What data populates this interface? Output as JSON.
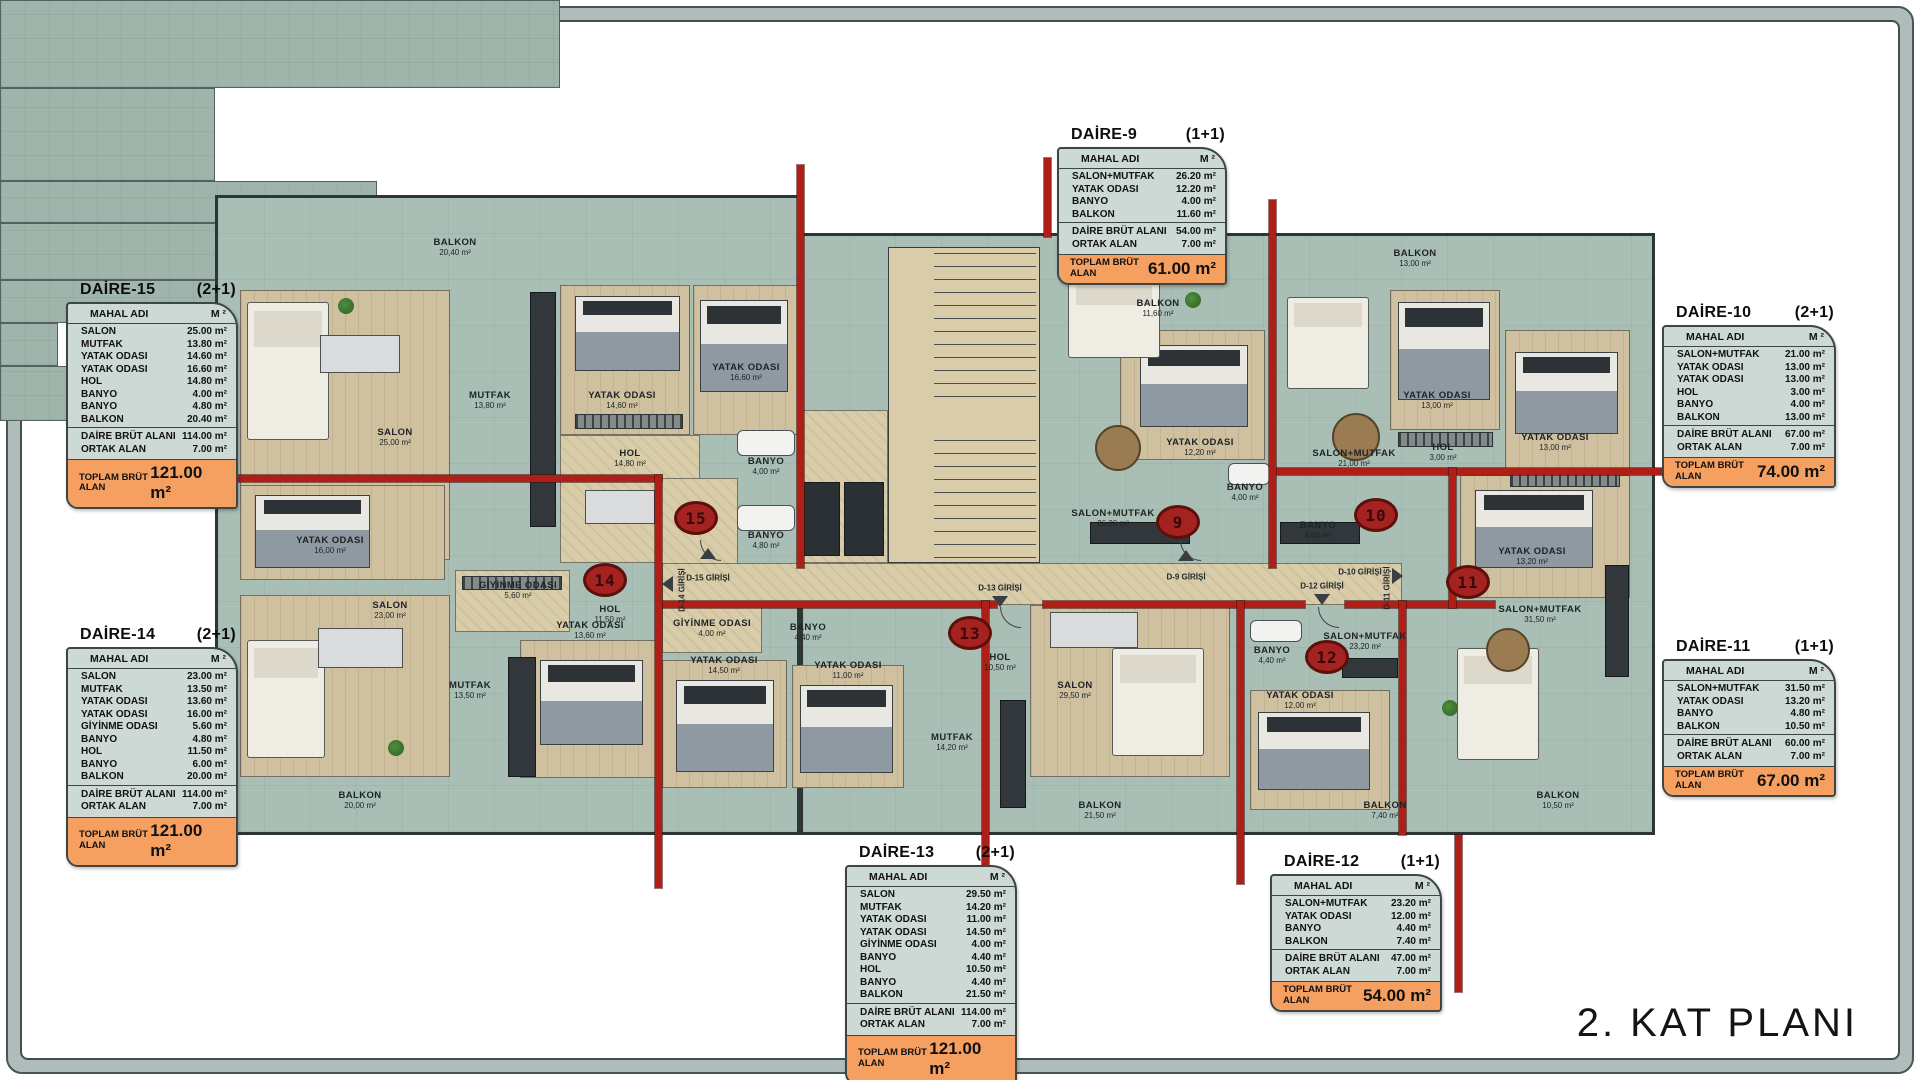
{
  "title": "2. KAT PLANI",
  "colors": {
    "section_red": "#ad1f17",
    "tile_green": "#a9beb4",
    "wood": "#cfc0a0",
    "corridor_tan": "#d8cca9",
    "total_orange": "#f59f60",
    "table_bg": "#ccd9d4"
  },
  "labels": {
    "mahal_adi": "MAHAL ADI",
    "m2": "M ²",
    "daire_brut": "DAİRE BRÜT ALANI",
    "ortak_alan": "ORTAK ALAN",
    "toplam_brut": "TOPLAM BRÜT ALAN"
  },
  "apartments": [
    {
      "name": "DAİRE-15",
      "type": "(2+1)",
      "rows": [
        {
          "label": "SALON",
          "value": "25.00 m²"
        },
        {
          "label": "MUTFAK",
          "value": "13.80 m²"
        },
        {
          "label": "YATAK ODASI",
          "value": "14.60 m²"
        },
        {
          "label": "YATAK ODASI",
          "value": "16.60 m²"
        },
        {
          "label": "HOL",
          "value": "14.80 m²"
        },
        {
          "label": "BANYO",
          "value": "4.00 m²"
        },
        {
          "label": "BANYO",
          "value": "4.80 m²"
        },
        {
          "label": "BALKON",
          "value": "20.40 m²"
        }
      ],
      "brut": "114.00 m²",
      "ortak": "7.00 m²",
      "toplam": "121.00 m²"
    },
    {
      "name": "DAİRE-14",
      "type": "(2+1)",
      "rows": [
        {
          "label": "SALON",
          "value": "23.00 m²"
        },
        {
          "label": "MUTFAK",
          "value": "13.50 m²"
        },
        {
          "label": "YATAK ODASI",
          "value": "13.60 m²"
        },
        {
          "label": "YATAK ODASI",
          "value": "16.00 m²"
        },
        {
          "label": "GİYİNME ODASI",
          "value": "5.60 m²"
        },
        {
          "label": "BANYO",
          "value": "4.80 m²"
        },
        {
          "label": "HOL",
          "value": "11.50 m²"
        },
        {
          "label": "BANYO",
          "value": "6.00 m²"
        },
        {
          "label": "BALKON",
          "value": "20.00 m²"
        }
      ],
      "brut": "114.00 m²",
      "ortak": "7.00 m²",
      "toplam": "121.00 m²"
    },
    {
      "name": "DAİRE-9",
      "type": "(1+1)",
      "rows": [
        {
          "label": "SALON+MUTFAK",
          "value": "26.20 m²"
        },
        {
          "label": "YATAK ODASI",
          "value": "12.20 m²"
        },
        {
          "label": "BANYO",
          "value": "4.00 m²"
        },
        {
          "label": "BALKON",
          "value": "11.60 m²"
        }
      ],
      "brut": "54.00 m²",
      "ortak": "7.00 m²",
      "toplam": "61.00 m²"
    },
    {
      "name": "DAİRE-10",
      "type": "(2+1)",
      "rows": [
        {
          "label": "SALON+MUTFAK",
          "value": "21.00 m²"
        },
        {
          "label": "YATAK ODASI",
          "value": "13.00 m²"
        },
        {
          "label": "YATAK ODASI",
          "value": "13.00 m²"
        },
        {
          "label": "HOL",
          "value": "3.00 m²"
        },
        {
          "label": "BANYO",
          "value": "4.00 m²"
        },
        {
          "label": "BALKON",
          "value": "13.00 m²"
        }
      ],
      "brut": "67.00 m²",
      "ortak": "7.00 m²",
      "toplam": "74.00 m²"
    },
    {
      "name": "DAİRE-11",
      "type": "(1+1)",
      "rows": [
        {
          "label": "SALON+MUTFAK",
          "value": "31.50 m²"
        },
        {
          "label": "YATAK ODASI",
          "value": "13.20 m²"
        },
        {
          "label": "BANYO",
          "value": "4.80 m²"
        },
        {
          "label": "BALKON",
          "value": "10.50 m²"
        }
      ],
      "brut": "60.00 m²",
      "ortak": "7.00 m²",
      "toplam": "67.00 m²"
    },
    {
      "name": "DAİRE-13",
      "type": "(2+1)",
      "rows": [
        {
          "label": "SALON",
          "value": "29.50 m²"
        },
        {
          "label": "MUTFAK",
          "value": "14.20 m²"
        },
        {
          "label": "YATAK ODASI",
          "value": "11.00 m²"
        },
        {
          "label": "YATAK ODASI",
          "value": "14.50 m²"
        },
        {
          "label": "GİYİNME ODASI",
          "value": "4.00 m²"
        },
        {
          "label": "BANYO",
          "value": "4.40 m²"
        },
        {
          "label": "HOL",
          "value": "10.50 m²"
        },
        {
          "label": "BANYO",
          "value": "4.40 m²"
        },
        {
          "label": "BALKON",
          "value": "21.50 m²"
        }
      ],
      "brut": "114.00 m²",
      "ortak": "7.00 m²",
      "toplam": "121.00 m²"
    },
    {
      "name": "DAİRE-12",
      "type": "(1+1)",
      "rows": [
        {
          "label": "SALON+MUTFAK",
          "value": "23.20 m²"
        },
        {
          "label": "YATAK ODASI",
          "value": "12.00 m²"
        },
        {
          "label": "BANYO",
          "value": "4.40 m²"
        },
        {
          "label": "BALKON",
          "value": "7.40 m²"
        }
      ],
      "brut": "47.00 m²",
      "ortak": "7.00 m²",
      "toplam": "54.00 m²"
    }
  ],
  "plan": {
    "markers": [
      "15",
      "14",
      "13",
      "9",
      "10",
      "11",
      "12"
    ],
    "entrances": [
      "D-15 GİRİŞİ",
      "D-14 GİRİŞİ",
      "D-13 GİRİŞİ",
      "D-9 GİRİŞİ",
      "D-12 GİRİŞİ",
      "D-10 GİRİŞİ",
      "D-11 GİRİŞİ"
    ],
    "rooms": [
      {
        "name": "BALKON",
        "area": "20,40 m²"
      },
      {
        "name": "SALON",
        "area": "25,00 m²"
      },
      {
        "name": "MUTFAK",
        "area": "13,80 m²"
      },
      {
        "name": "YATAK ODASI",
        "area": "14,60 m²"
      },
      {
        "name": "YATAK ODASI",
        "area": "16,60 m²"
      },
      {
        "name": "HOL",
        "area": "14,80 m²"
      },
      {
        "name": "BANYO",
        "area": "4,00 m²"
      },
      {
        "name": "BANYO",
        "area": "4,80 m²"
      },
      {
        "name": "YATAK ODASI",
        "area": "16,00 m²"
      },
      {
        "name": "GİYİNME ODASI",
        "area": "5,60 m²"
      },
      {
        "name": "HOL",
        "area": "11,50 m²"
      },
      {
        "name": "SALON",
        "area": "23,00 m²"
      },
      {
        "name": "MUTFAK",
        "area": "13,50 m²"
      },
      {
        "name": "YATAK ODASI",
        "area": "13,60 m²"
      },
      {
        "name": "BALKON",
        "area": "20,00 m²"
      },
      {
        "name": "GİYİNME ODASI",
        "area": "4,00 m²"
      },
      {
        "name": "BANYO",
        "area": "4,40 m²"
      },
      {
        "name": "YATAK ODASI",
        "area": "14,50 m²"
      },
      {
        "name": "YATAK ODASI",
        "area": "11,00 m²"
      },
      {
        "name": "MUTFAK",
        "area": "14,20 m²"
      },
      {
        "name": "HOL",
        "area": "10,50 m²"
      },
      {
        "name": "SALON",
        "area": "29,50 m²"
      },
      {
        "name": "BALKON",
        "area": "21,50 m²"
      },
      {
        "name": "BALKON",
        "area": "11,60 m²"
      },
      {
        "name": "YATAK ODASI",
        "area": "12,20 m²"
      },
      {
        "name": "SALON+MUTFAK",
        "area": "26,20 m²"
      },
      {
        "name": "BANYO",
        "area": "4,00 m²"
      },
      {
        "name": "SALON+MUTFAK",
        "area": "21,00 m²"
      },
      {
        "name": "YATAK ODASI",
        "area": "13,00 m²"
      },
      {
        "name": "YATAK ODASI",
        "area": "13,00 m²"
      },
      {
        "name": "HOL",
        "area": "3,00 m²"
      },
      {
        "name": "BANYO",
        "area": "4,00 m²"
      },
      {
        "name": "BALKON",
        "area": "13,00 m²"
      },
      {
        "name": "YATAK ODASI",
        "area": "13,20 m²"
      },
      {
        "name": "SALON+MUTFAK",
        "area": "31,50 m²"
      },
      {
        "name": "BALKON",
        "area": "10,50 m²"
      },
      {
        "name": "BANYO",
        "area": "4,40 m²"
      },
      {
        "name": "SALON+MUTFAK",
        "area": "23,20 m²"
      },
      {
        "name": "YATAK ODASI",
        "area": "12,00 m²"
      },
      {
        "name": "BALKON",
        "area": "7,40 m²"
      }
    ]
  }
}
